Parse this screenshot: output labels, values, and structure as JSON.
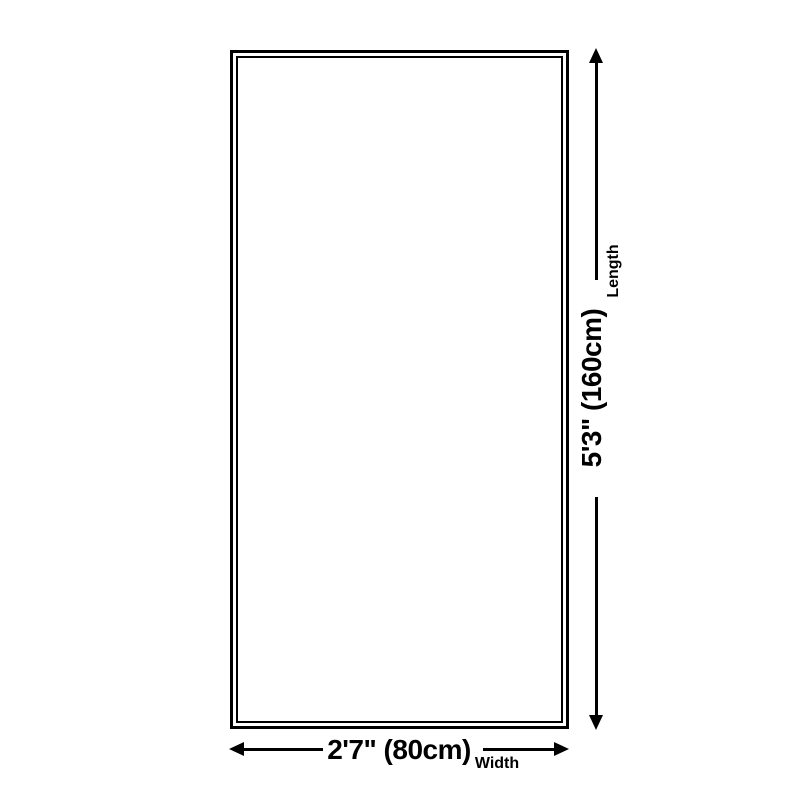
{
  "diagram": {
    "type": "product-size-diagram",
    "shape": "rectangle",
    "colors": {
      "background": "#ffffff",
      "line": "#000000",
      "text": "#000000",
      "rug_fill": "#ffffff"
    },
    "dimensions": {
      "length": {
        "label": "Length",
        "value": "5'3\" (160cm)"
      },
      "width": {
        "label": "Width",
        "value": "2'7\" (80cm)"
      }
    }
  }
}
